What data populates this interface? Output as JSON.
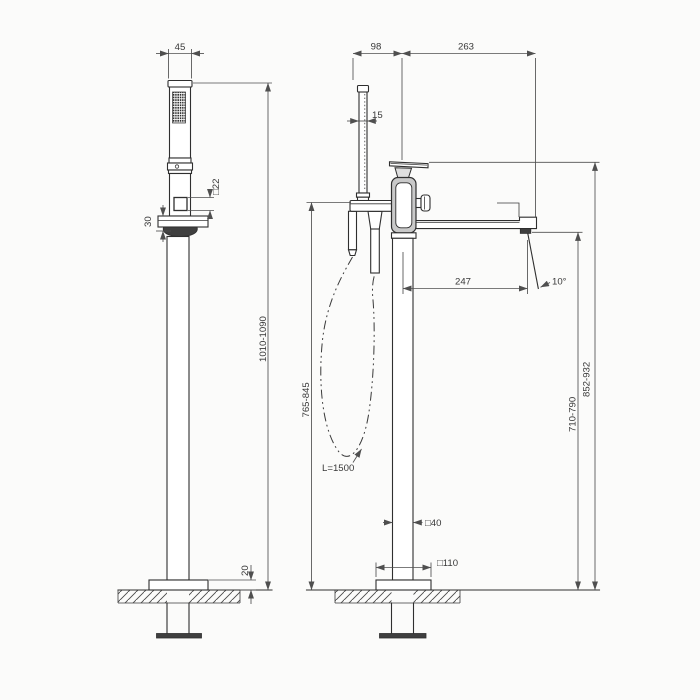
{
  "colors": {
    "background": "#fbfbfa",
    "line": "#2f2f2f",
    "dimension_line": "#4f4f4f",
    "text": "#383838",
    "dark_fill": "#3f3f3f",
    "body_shade": "#c9c9c9"
  },
  "views": {
    "side": {
      "dims": {
        "head_width": "45",
        "square_detail": "□22",
        "holder_height": "30",
        "overall_height": "1010-1090",
        "base_plate_thickness": "20"
      }
    },
    "front": {
      "dims": {
        "shower_offset": "98",
        "spout_span": "263",
        "shower_thickness": "15",
        "spout_reach": "247",
        "flow_angle": "10°",
        "holder_height_range": "765-845",
        "spout_height_range": "710-790",
        "handle_height_range": "852-932",
        "column_section": "□40",
        "base_plate_size": "□110",
        "hose_length": "L=1500"
      }
    }
  }
}
